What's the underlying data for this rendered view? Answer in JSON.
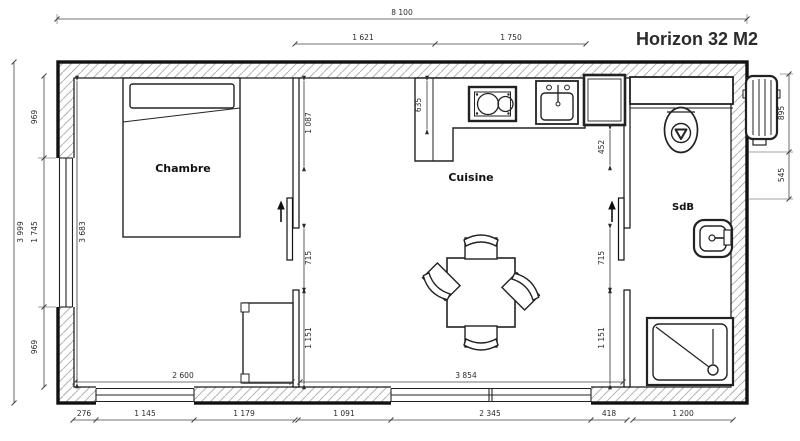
{
  "title": {
    "text": "Horizon 32 M2",
    "color": "#e8432e"
  },
  "rooms": {
    "bedroom": "Chambre",
    "kitchen": "Cuisine",
    "bathroom": "SdB"
  },
  "colors": {
    "line": "#1a1a1a",
    "hatch": "#b3b3b3",
    "dim_text": "#2b2b2b"
  },
  "dims": {
    "overall_width": "8 100",
    "top_seg1": "1 621",
    "top_seg2": "1 750",
    "overall_height": "3 999",
    "left_top": "969",
    "left_mid": "1 745",
    "left_bottom": "969",
    "bedroom_height": "3 683",
    "right_top": "895",
    "right_mid": "545",
    "partition1_top": "1 087",
    "counter_depth": "635",
    "partition2_top": "452",
    "door1_opening": "715",
    "door2_opening": "715",
    "partition1_bottom": "1 151",
    "partition2_bottom": "1 151",
    "bedroom_width": "2 600",
    "kitchen_width": "3 854",
    "bottom": [
      "276",
      "1 145",
      "1 179",
      "1 091",
      "2 345",
      "418",
      "1 200"
    ]
  }
}
